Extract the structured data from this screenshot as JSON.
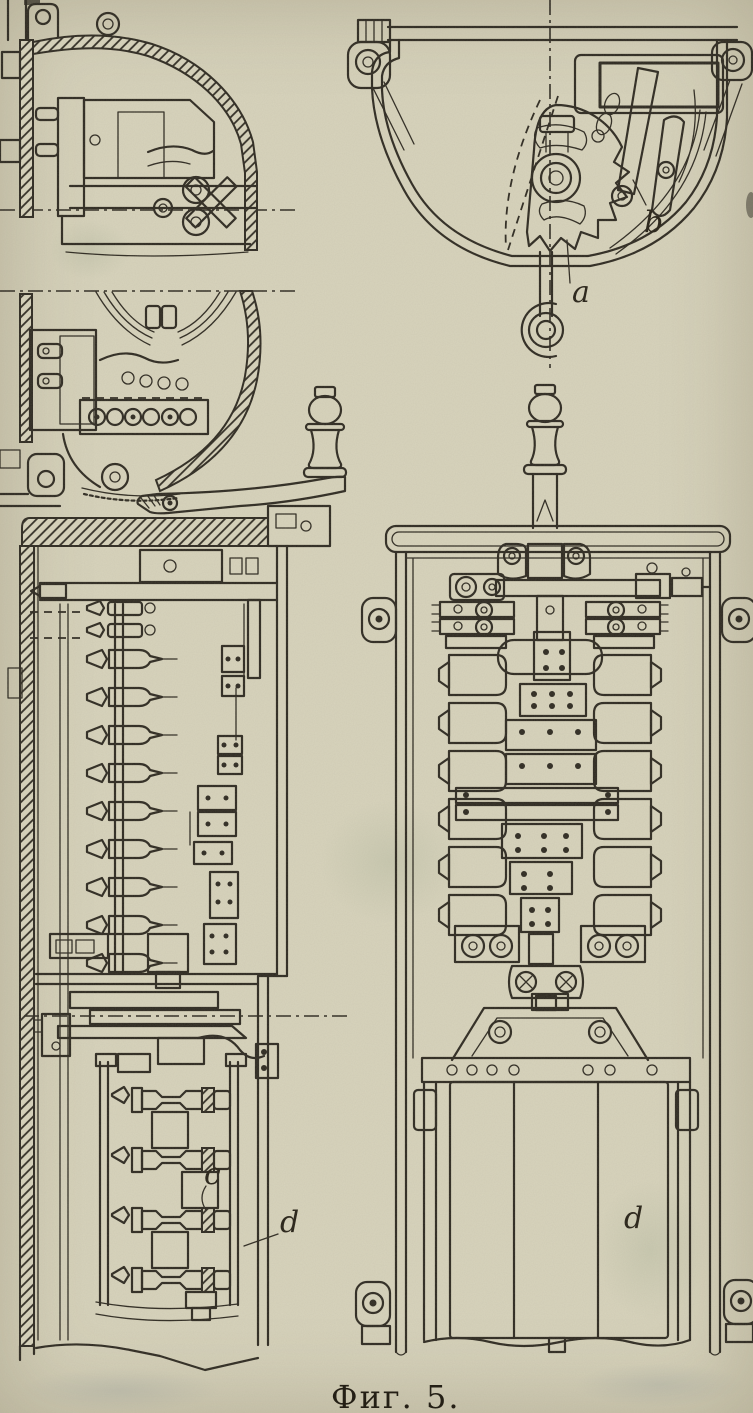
{
  "figure": {
    "caption": "Фиг. 5.",
    "part_labels": {
      "a": "a",
      "b": "b",
      "c": "c",
      "d_side": "d",
      "d_front": "d"
    }
  },
  "colors": {
    "paper": "#d8d4bd",
    "ink": "#2c2820"
  }
}
